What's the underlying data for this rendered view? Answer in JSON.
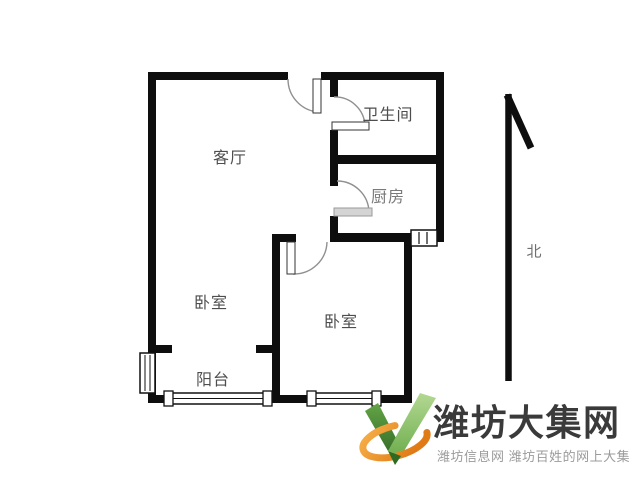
{
  "floorplan": {
    "rooms": [
      {
        "name": "living-room",
        "label": "客厅"
      },
      {
        "name": "bathroom",
        "label": "卫生间"
      },
      {
        "name": "kitchen",
        "label": "厨房"
      },
      {
        "name": "bedroom-left",
        "label": "卧室"
      },
      {
        "name": "bedroom-right",
        "label": "卧室"
      },
      {
        "name": "balcony",
        "label": "阳台"
      }
    ],
    "compass": {
      "label": "北"
    }
  },
  "watermark": {
    "site_name": "潍坊大集网",
    "tagline": "潍坊信息网 潍坊百姓的网上大集"
  },
  "colors": {
    "wall": "#0e0e0e",
    "door_line": "#909090",
    "label_text": "#4d4d4d",
    "logo_text": "#3a3a3a",
    "tagline_text": "#9b9b9b",
    "logo_green_dark": "#39702a",
    "logo_green_light": "#9ecb77",
    "logo_orange": "#ef8e24"
  }
}
